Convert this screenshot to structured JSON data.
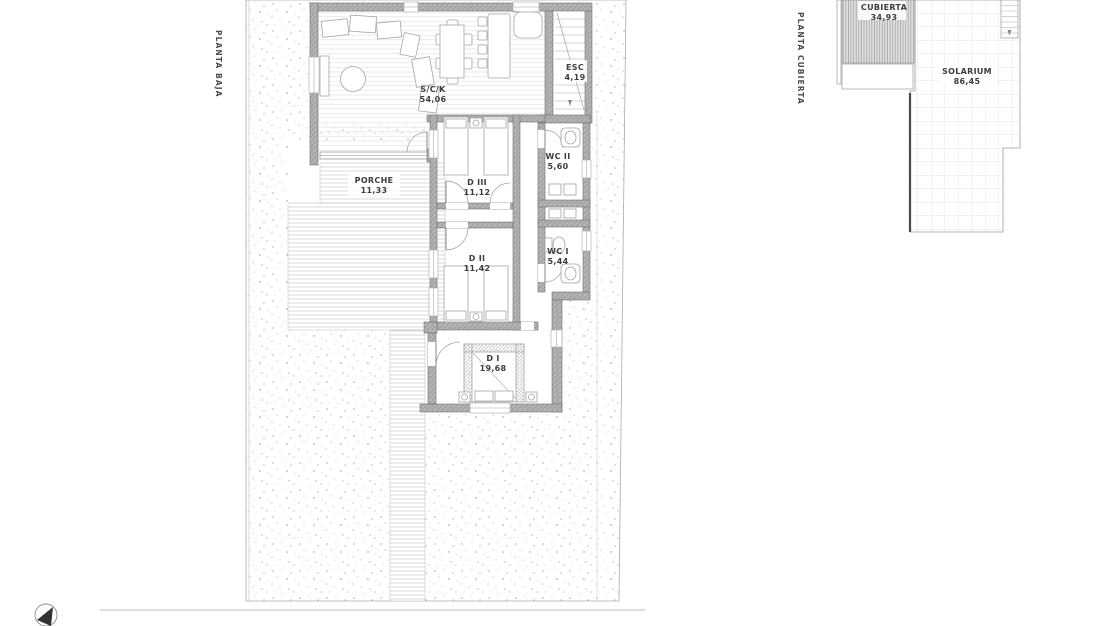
{
  "document": {
    "type": "architectural-floor-plan-sheet",
    "background": "#ffffff"
  },
  "plans": {
    "planta_baja": {
      "side_label": "PLANTA BAJA",
      "rooms": [
        {
          "name": "S/C/K",
          "area": "54,06"
        },
        {
          "name": "ESC",
          "area": "4,19"
        },
        {
          "name": "WC II",
          "area": "5,60"
        },
        {
          "name": "D III",
          "area": "11,12"
        },
        {
          "name": "PORCHE",
          "area": "11,33"
        },
        {
          "name": "D II",
          "area": "11,42"
        },
        {
          "name": "WC I",
          "area": "5,44"
        },
        {
          "name": "D I",
          "area": "19,68"
        }
      ]
    },
    "planta_cubierta": {
      "side_label": "PLANTA CUBIERTA",
      "rooms": [
        {
          "name": "CUBIERTA",
          "area": "34,93"
        },
        {
          "name": "SOLARIUM",
          "area": "86,45"
        }
      ]
    }
  },
  "icons": {
    "north_arrow": "compass-north-needle"
  },
  "colors": {
    "wall_fill": "#b2b2b2",
    "wall_edge": "#6f6f6f",
    "thin_line": "#9a9a9a",
    "texture_dot": "#c3c3c3",
    "grid_line": "#dcdcdc",
    "text": "#3d3d3d"
  }
}
